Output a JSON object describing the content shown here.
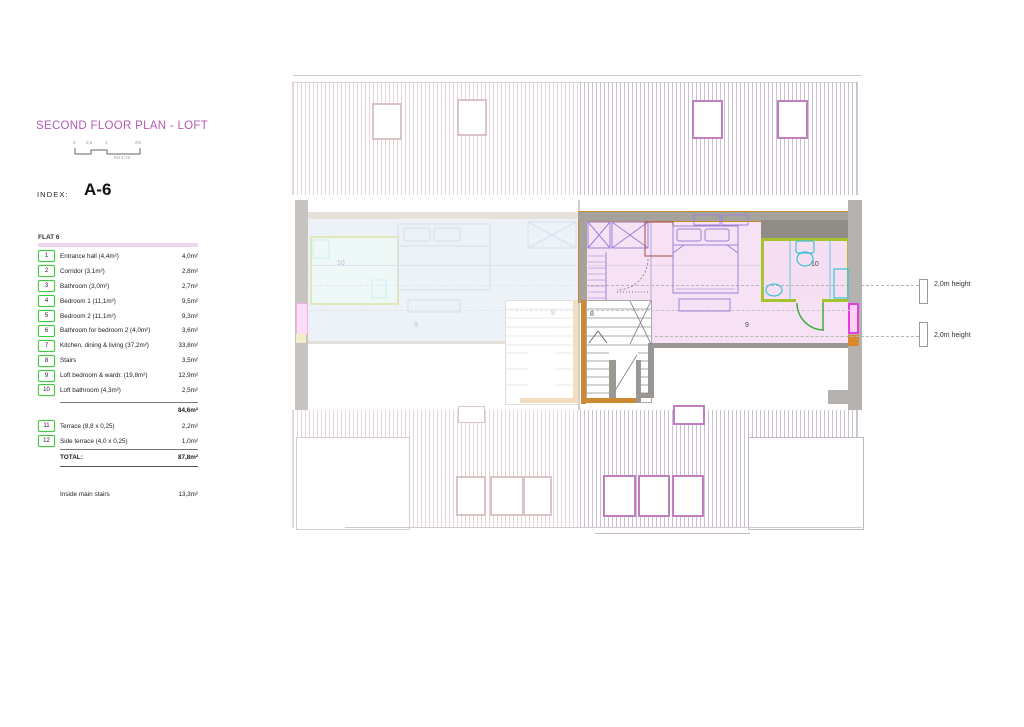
{
  "header": {
    "title": "SECOND FLOOR PLAN - LOFT",
    "index_label": "INDEX:",
    "index_value": "A-6",
    "scale": {
      "ticks": [
        "0",
        "0,5",
        "1",
        "2m"
      ],
      "note": "MJ 1:75"
    }
  },
  "flat_table": {
    "title": "FLAT 6",
    "rows": [
      {
        "num": "1",
        "label": "Entrance hall (4,4m²)",
        "area": "4,0m²"
      },
      {
        "num": "2",
        "label": "Corridor (3,1m²)",
        "area": "2,8m²"
      },
      {
        "num": "3",
        "label": "Bathroom (3,0m²)",
        "area": "2,7m²"
      },
      {
        "num": "4",
        "label": "Bedroom 1  (11,1m²)",
        "area": "9,5m²"
      },
      {
        "num": "5",
        "label": "Bedroom 2  (11,1m²)",
        "area": "9,3m²"
      },
      {
        "num": "6",
        "label": "Bathroom for bedroom 2 (4,0m²)",
        "area": "3,6m²"
      },
      {
        "num": "7",
        "label": "Kitchen, dining & living (37,2m²)",
        "area": "33,8m²"
      },
      {
        "num": "8",
        "label": "Stairs",
        "area": "3,5m²"
      },
      {
        "num": "9",
        "label": "Loft bedroom & wardr. (19,8m²)",
        "area": "12,9m²"
      },
      {
        "num": "10",
        "label": "Loft bathroom (4,3m²)",
        "area": "2,5m²"
      }
    ],
    "subtotal": "84,6m²",
    "extra_rows": [
      {
        "num": "11",
        "label": "Terrace (8,8 x 0,25)",
        "area": "2,2m²"
      },
      {
        "num": "12",
        "label": "Side terrace (4,0 x 0,25)",
        "area": "1,0m²"
      }
    ],
    "total_label": "TOTAL:",
    "total_value": "87,8m²",
    "note_label": "Inside main stairs",
    "note_value": "13,3m²"
  },
  "plan": {
    "room_labels": {
      "left_bathroom": "10",
      "left_loft": "9",
      "left_stairs": "8",
      "right_stairs": "8",
      "right_loft": "9",
      "right_bathroom": "10"
    },
    "annotations": {
      "upper": "2,0m height",
      "lower": "2,0m height"
    }
  },
  "colors": {
    "title_accent": "#b55ab5",
    "table_band": "#eed7ec",
    "badge_green": "#3ecb3e",
    "plan_pink": "#f7e2f5",
    "wall_orange": "#c8862d",
    "wall_grey": "#a5a19c",
    "bath_green": "#a6c32d",
    "fixture_cyan": "#3cc3d5",
    "furniture_purple": "#9d83d6",
    "window_magenta": "#e23ee2"
  }
}
